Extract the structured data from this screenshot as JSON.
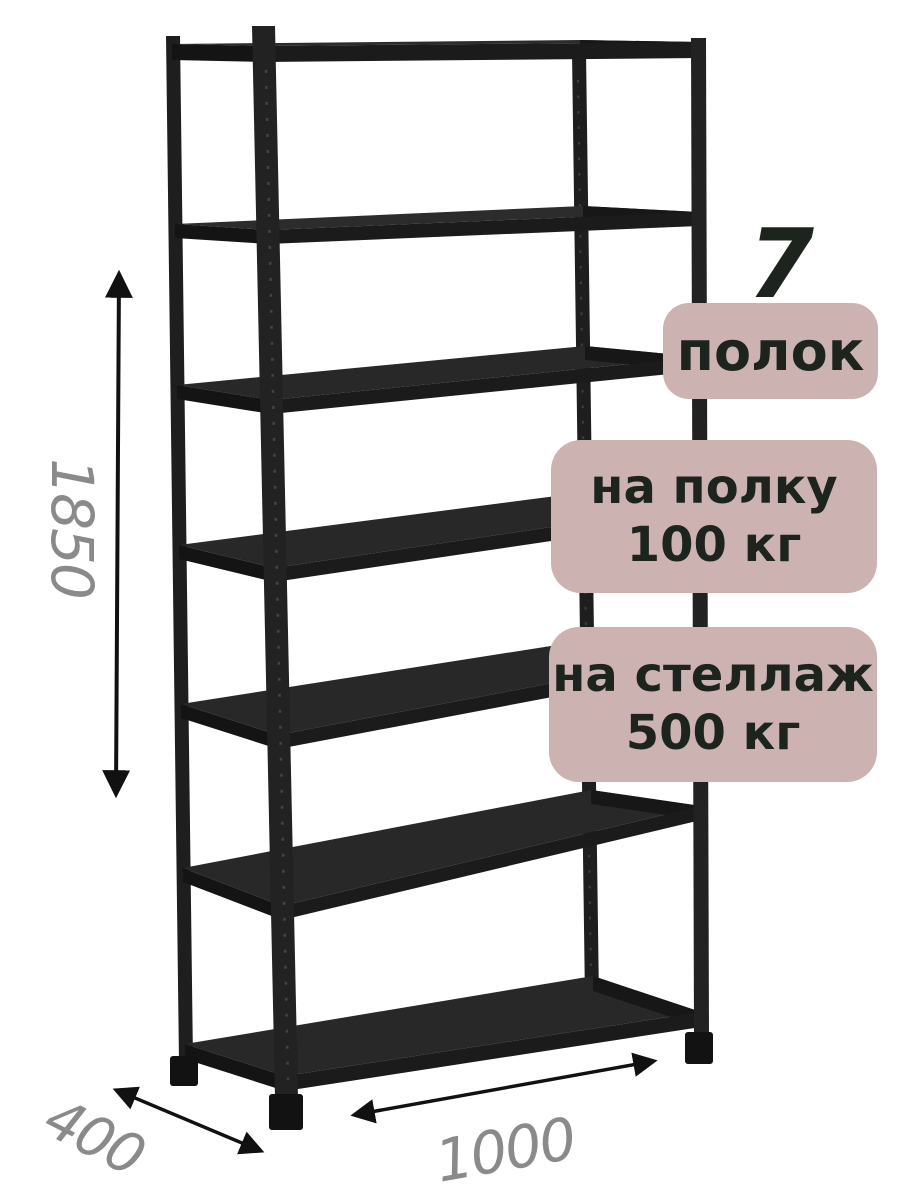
{
  "product": {
    "shelf_count": {
      "number": "7",
      "label": "полок"
    },
    "load_per_shelf": {
      "line1": "на полку",
      "line2": "100 кг"
    },
    "load_per_rack": {
      "line1": "на стеллаж",
      "line2": "500 кг"
    },
    "dimensions": {
      "height": "1850",
      "depth": "400",
      "width": "1000"
    }
  },
  "illustration": {
    "subject": "black-metal-boltless-shelving-rack",
    "shelves_drawn": 7,
    "view": "front-left perspective"
  },
  "colors": {
    "background": "#ffffff",
    "rack_dark": "#1f1f1f",
    "rack_surface": "#282828",
    "rack_edge": "#151515",
    "badge_bg": "#ccb2b1",
    "badge_text": "#1d241e",
    "dimension_text": "#8a8a8a",
    "arrow": "#111111"
  }
}
